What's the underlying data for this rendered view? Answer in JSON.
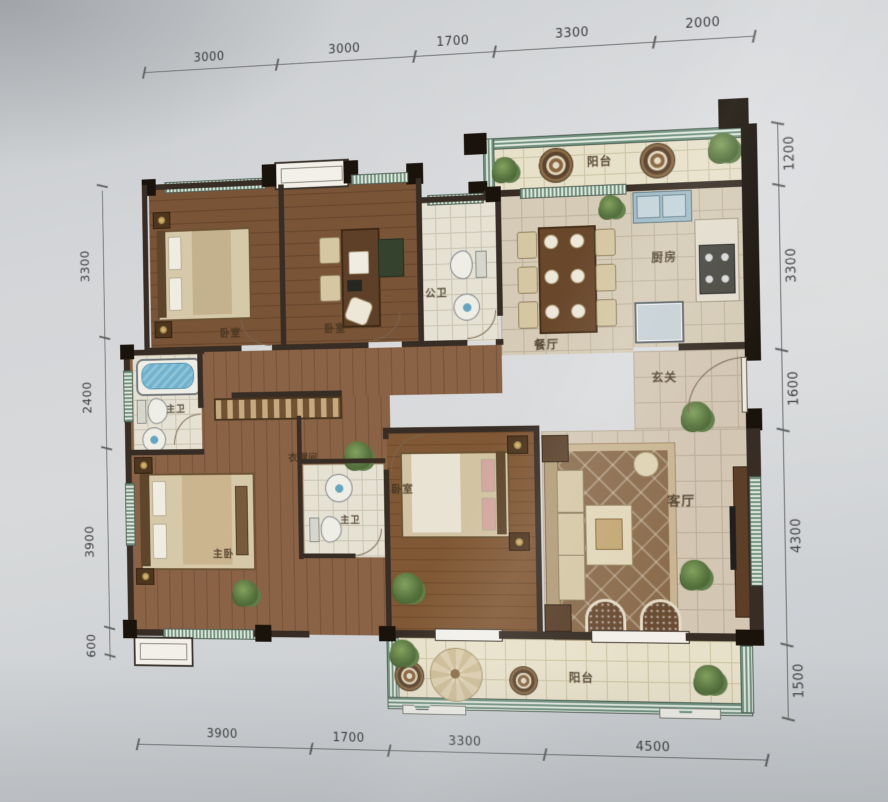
{
  "title": "residential floor plan photo",
  "rooms": {
    "balcony_top": {
      "label": "阳台"
    },
    "kitchen": {
      "label": "厨房"
    },
    "dining": {
      "label": "餐厅"
    },
    "guest_bath": {
      "label": "公卫"
    },
    "bedroom_a": {
      "label": "卧室"
    },
    "bedroom_b": {
      "label": "卧室"
    },
    "foyer": {
      "label": "玄关"
    },
    "living": {
      "label": "客厅"
    },
    "master_bath_a": {
      "label": "主卫"
    },
    "cloakroom": {
      "label": "衣帽间"
    },
    "master_bath_b": {
      "label": "主卫"
    },
    "master_bedroom": {
      "label": "主卧"
    },
    "bedroom_c": {
      "label": "卧室"
    },
    "balcony_bottom": {
      "label": "阳台"
    }
  },
  "dimensions_mm": {
    "top": [
      "3000",
      "3000",
      "1700",
      "3300",
      "2000"
    ],
    "right": [
      "1200",
      "3300",
      "1600",
      "4300",
      "1500"
    ],
    "left": [
      "3300",
      "2400",
      "3900",
      "600"
    ],
    "bottom": [
      "3900",
      "1700",
      "3300",
      "4500"
    ]
  },
  "colors": {
    "wall": "#352a20",
    "wood_floor": "#7b5232",
    "tile_floor": "#d8cdb6",
    "balcony_tile": "#ece4ca",
    "window_band": "#6f947f",
    "water_blue": "#6db5d2",
    "paper": "#d3d5d8"
  }
}
